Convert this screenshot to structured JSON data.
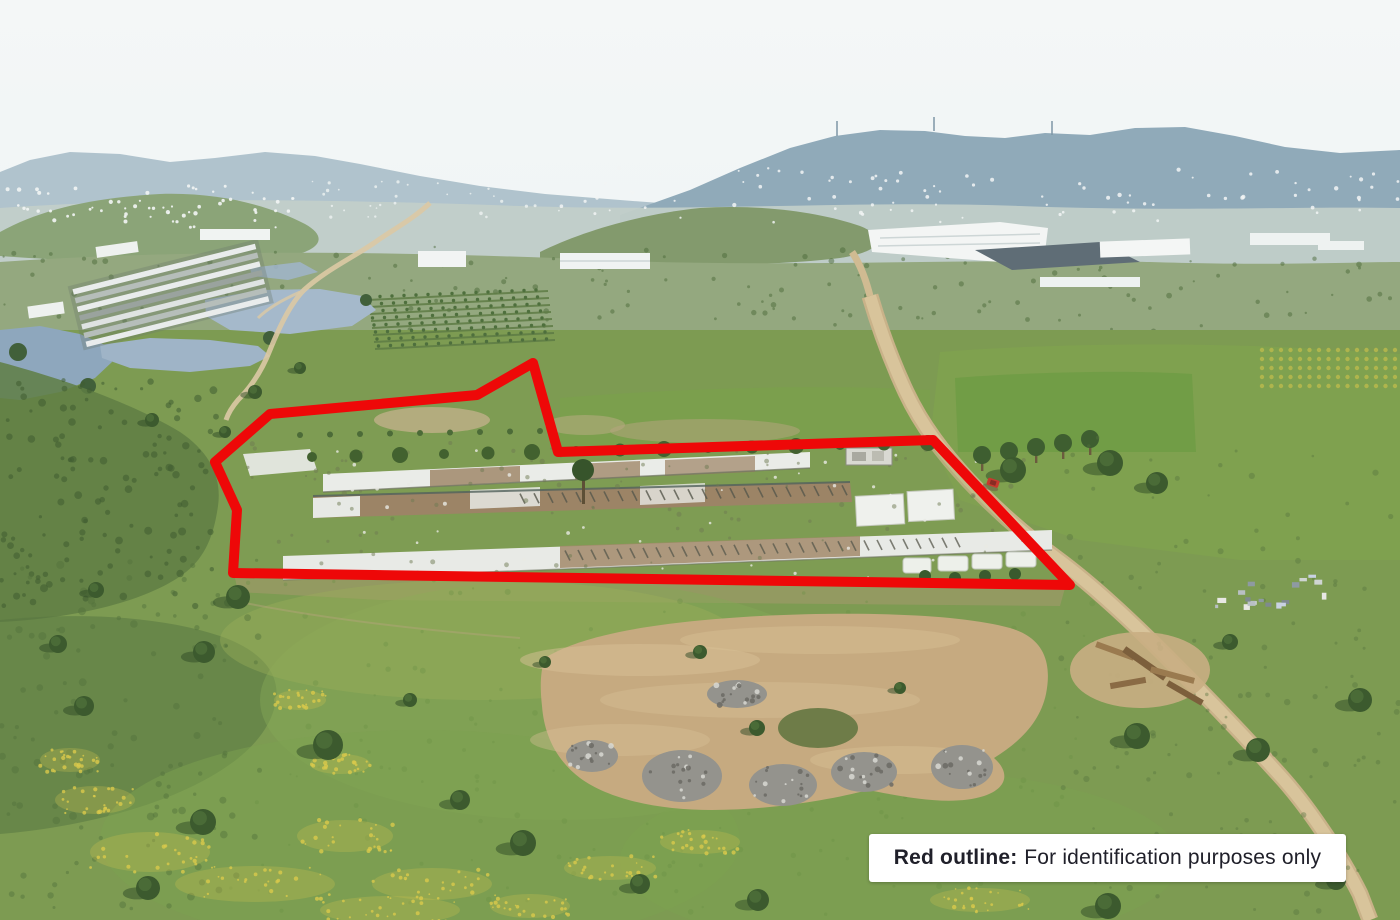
{
  "overlay": {
    "label_prefix": "Red outline:",
    "label_rest": "For identification purposes only"
  },
  "colors": {
    "outline_red": "#ee0808",
    "label_background": "#ffffff",
    "label_text": "#20202a",
    "sky_haze": "#eef3f5",
    "distant_hills": "#9fb6c3",
    "water": "#9fb4c7",
    "grass": "#7d9b52",
    "dirt_road": "#d9c59c",
    "bare_earth": "#c6aa80",
    "ash_gray": "#94938d",
    "red_car": "#c63a2e"
  },
  "scene": {
    "type": "aerial-drone-photograph",
    "subject": "rural land parcel outlined in red containing three long derelict farm structures, with ponds, greenhouses, dirt road and hazy hills beyond"
  }
}
